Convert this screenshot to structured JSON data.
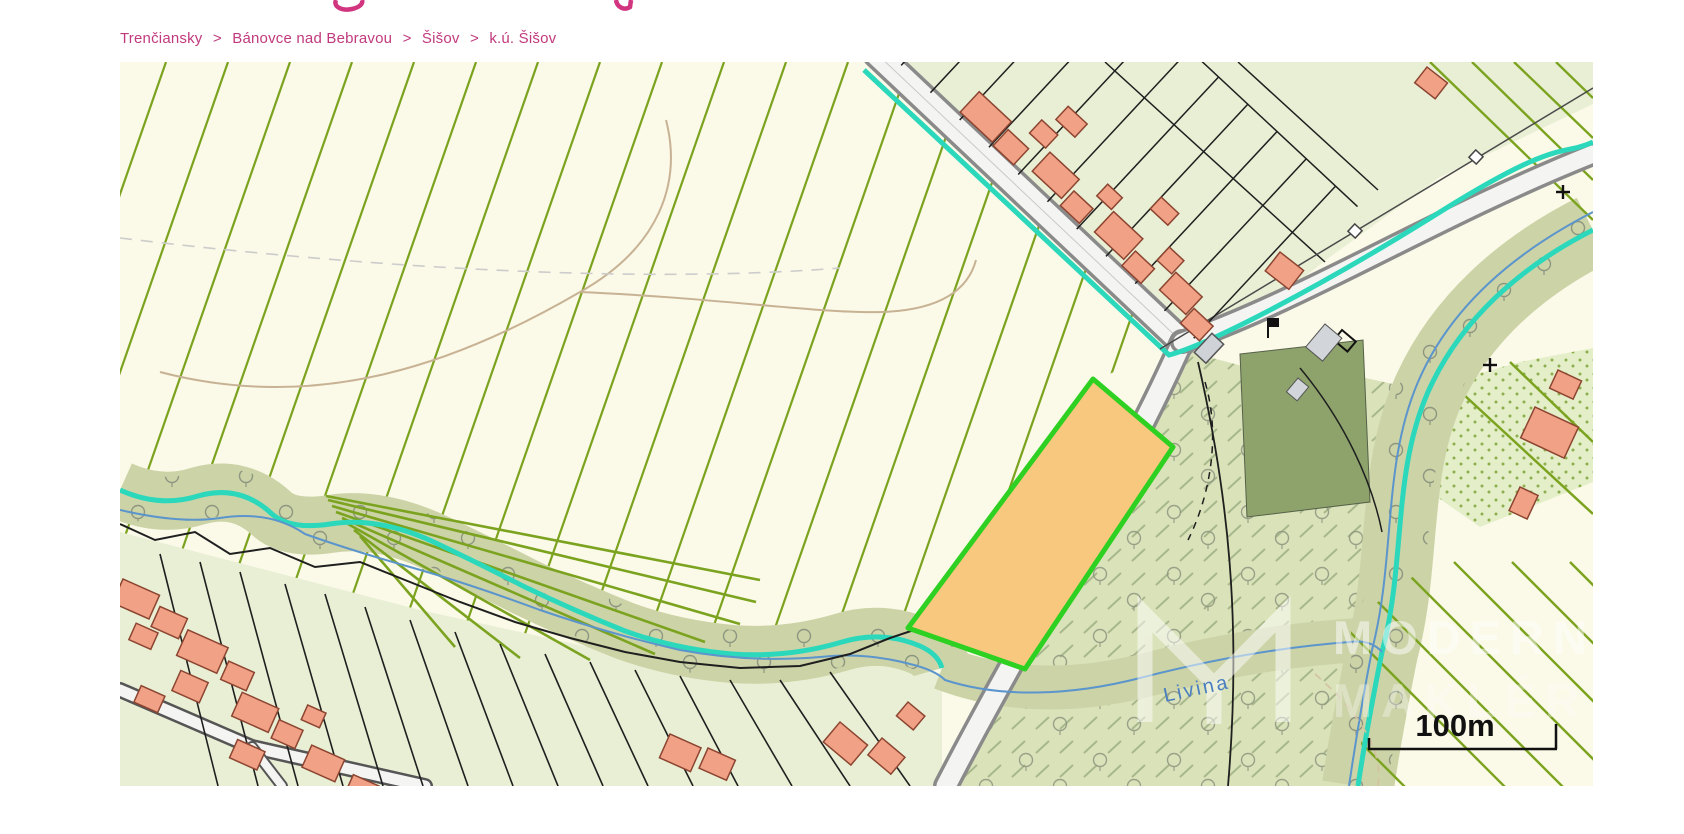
{
  "breadcrumb": {
    "items": [
      "Trenčiansky",
      "Bánovce nad Bebravou",
      "Šišov",
      "k.ú. Šišov"
    ],
    "separator": ">"
  },
  "map": {
    "stream_label": "Livina",
    "scale_label": "100m",
    "watermark": {
      "line1": "MODERN",
      "line2": "MAKLÉR"
    }
  },
  "colors": {
    "breadcrumb_pink": "#c13a7d",
    "heading_pink": "#d23580",
    "field_cream": "#fbf9e7",
    "parcel_stripe_olive": "#7ba31f",
    "village_green": "#e9efd5",
    "meadow_green": "#d9e2b8",
    "riparian_khaki": "#ccd3a7",
    "stream_teal": "#2bd8bb",
    "stream_blue": "#5b95cc",
    "building_salmon": "#f1a185",
    "highlighted_parcel_fill": "#f8c87e",
    "highlighted_parcel_border": "#2ed022",
    "dark_green_area": "#8ea36b",
    "road_casing": "#8a8a8a"
  }
}
